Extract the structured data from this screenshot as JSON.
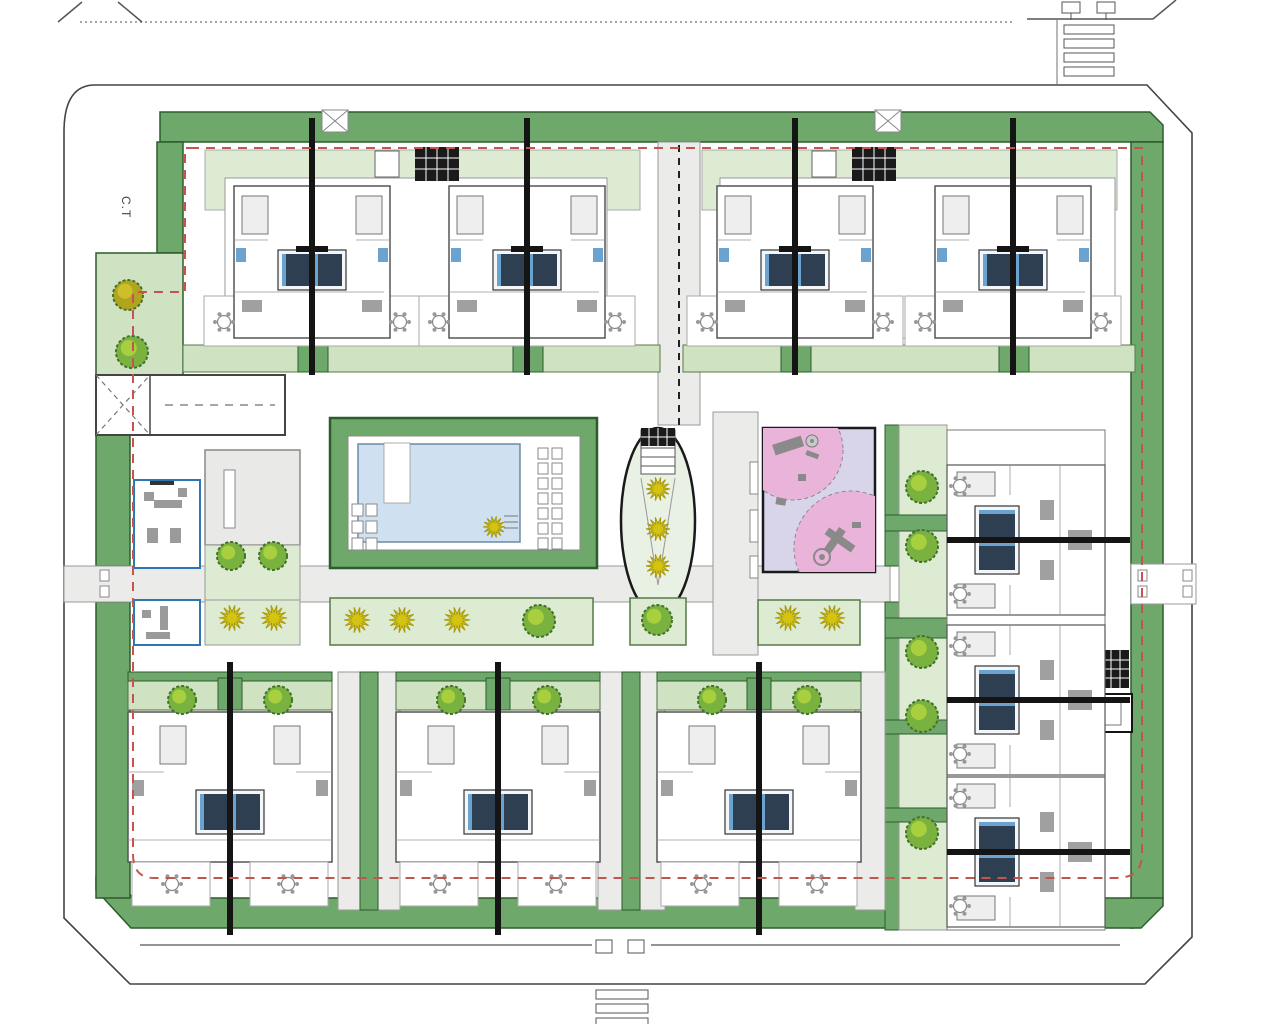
{
  "labels": {
    "transformer_station": "C.T"
  },
  "palette": {
    "band": "#6fa86b",
    "band_dark": "#2d5b2d",
    "light_green": "#dcebd2",
    "light_green2": "#cfe3c2",
    "walk": "#ebebe9",
    "walk_edge": "#9a9a9a",
    "pool": "#cfe1f0",
    "pool_edge": "#6b8aa5",
    "lavender": "#d8d4ea",
    "pink": "#e9b3da",
    "red_boundary": "#c4544f",
    "road_line": "#555555",
    "tree": "#79b23f",
    "tree_dark": "#44702c",
    "tree_light": "#a8cf3e",
    "tree_olive": "#b1a51e",
    "plant_yellow": "#d3c413",
    "plant_yellow_edge": "#a89a10",
    "navy_bed": "#2f3f52",
    "bath_blue": "#6ba3d0",
    "wall": "#141414",
    "unit_edge": "#555555",
    "furniture": "#a0a0a0",
    "club_blue": "#2e75b6"
  },
  "site": {
    "trees": [
      {
        "x": 128,
        "y": 295,
        "r": 15,
        "variant": "olive"
      },
      {
        "x": 132,
        "y": 352,
        "r": 16,
        "variant": "green"
      },
      {
        "x": 231,
        "y": 556,
        "r": 14,
        "variant": "green"
      },
      {
        "x": 273,
        "y": 556,
        "r": 14,
        "variant": "green"
      },
      {
        "x": 539,
        "y": 621,
        "r": 16,
        "variant": "green"
      },
      {
        "x": 657,
        "y": 620,
        "r": 15,
        "variant": "green"
      },
      {
        "x": 922,
        "y": 487,
        "r": 16,
        "variant": "green"
      },
      {
        "x": 922,
        "y": 546,
        "r": 16,
        "variant": "green"
      },
      {
        "x": 922,
        "y": 652,
        "r": 16,
        "variant": "green"
      },
      {
        "x": 922,
        "y": 716,
        "r": 16,
        "variant": "green"
      },
      {
        "x": 922,
        "y": 833,
        "r": 16,
        "variant": "green"
      },
      {
        "x": 182,
        "y": 700,
        "r": 14,
        "variant": "green"
      },
      {
        "x": 278,
        "y": 700,
        "r": 14,
        "variant": "green"
      },
      {
        "x": 451,
        "y": 700,
        "r": 14,
        "variant": "green"
      },
      {
        "x": 547,
        "y": 700,
        "r": 14,
        "variant": "green"
      },
      {
        "x": 712,
        "y": 700,
        "r": 14,
        "variant": "green"
      },
      {
        "x": 807,
        "y": 700,
        "r": 14,
        "variant": "green"
      }
    ],
    "yellow_plants": [
      {
        "x": 232,
        "y": 618,
        "r": 13
      },
      {
        "x": 274,
        "y": 618,
        "r": 13
      },
      {
        "x": 494,
        "y": 527,
        "r": 11
      },
      {
        "x": 357,
        "y": 620,
        "r": 13
      },
      {
        "x": 402,
        "y": 620,
        "r": 13
      },
      {
        "x": 457,
        "y": 620,
        "r": 13
      },
      {
        "x": 658,
        "y": 489,
        "r": 12
      },
      {
        "x": 658,
        "y": 529,
        "r": 12
      },
      {
        "x": 658,
        "y": 566,
        "r": 12
      },
      {
        "x": 788,
        "y": 618,
        "r": 13
      },
      {
        "x": 832,
        "y": 618,
        "r": 13
      }
    ],
    "top_units": {
      "centers": [
        312,
        527,
        795,
        1013
      ],
      "roof_y": 150
    },
    "bottom_units": {
      "centers": [
        230,
        498,
        759
      ],
      "base_y": 712
    },
    "right_units": {
      "centers_y": [
        540,
        700,
        852
      ],
      "left_x": 947
    },
    "pool": {
      "loungers_right_rows": 7,
      "loungers_left_rows": 3
    },
    "playground": {
      "circles": [
        {
          "cx": 793,
          "cy": 450,
          "r": 50
        },
        {
          "cx": 851,
          "cy": 548,
          "r": 57
        }
      ]
    },
    "crossings": {
      "top_right_bars": 4,
      "bottom_bars": 3
    }
  }
}
